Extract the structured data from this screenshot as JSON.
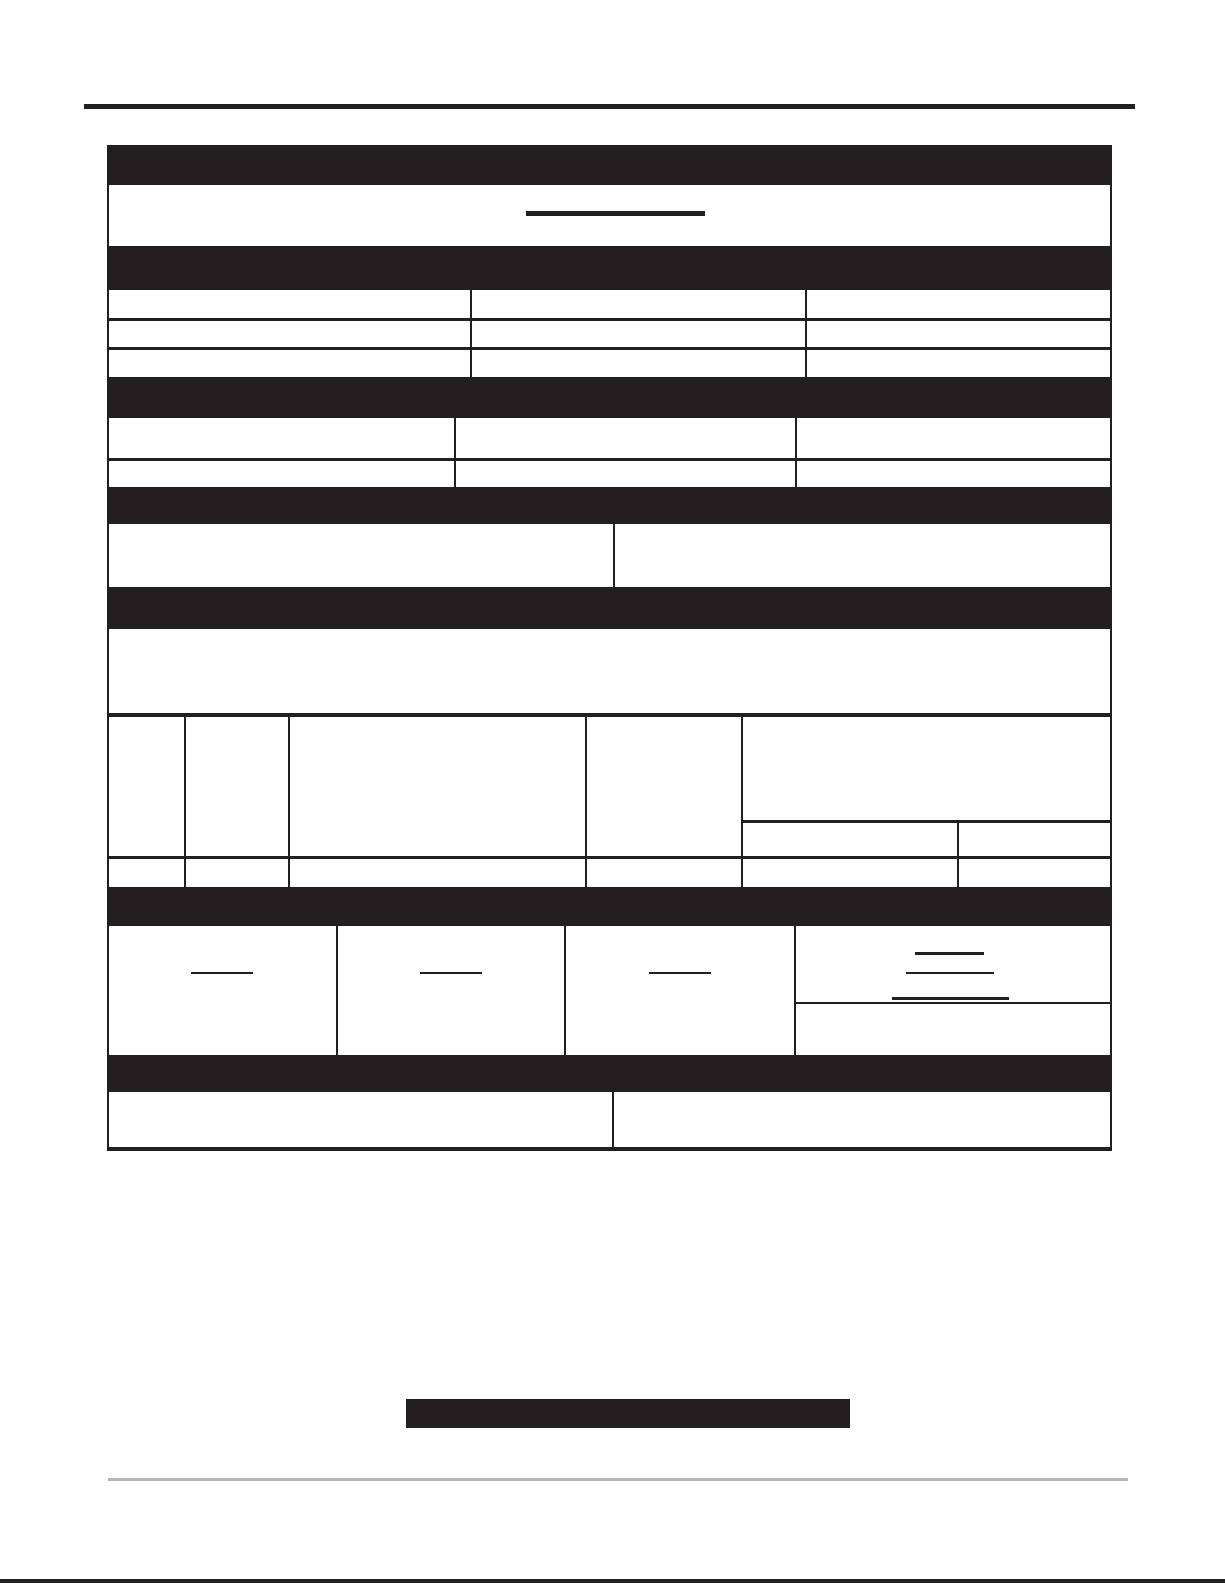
{
  "document": {
    "kind": "blank-scanned-form",
    "visible_text": "",
    "colors": {
      "paper": "#ffffff",
      "ink": "#231f20",
      "footer_rule_gray": "#b4b4b8"
    },
    "structure": {
      "section_header_bars": 7,
      "title_box_fill_lines": 1,
      "three_column_table_rows": 3,
      "second_table_rows": 2,
      "two_column_rows": 2,
      "grid_table_columns": 5,
      "bottom_section_columns": 4,
      "short_fill_lines": 6,
      "solid_footer_box": 1
    }
  }
}
